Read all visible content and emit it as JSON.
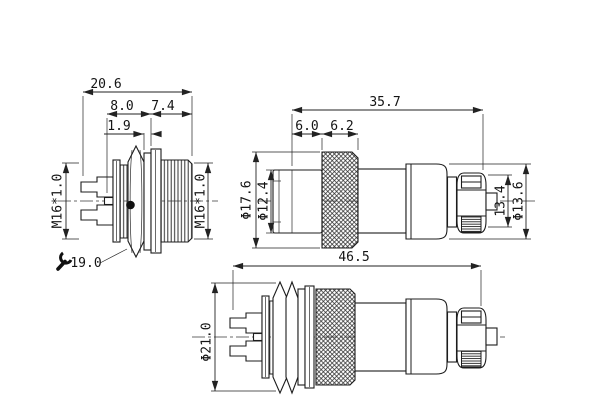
{
  "drawing": {
    "title_hint": "connector dimensional drawing",
    "colors": {
      "line": "#1c1c1c",
      "background": "#ffffff"
    },
    "socket_view": {
      "len_total": "20.6",
      "len_rear": "8.0",
      "len_front": "7.4",
      "washer_thickness": "1.9",
      "thread_rear": "M16*1.0",
      "thread_front": "M16*1.0",
      "hex_wrench_size": "19.0"
    },
    "plug_view": {
      "len_total": "35.7",
      "seg_front": "6.0",
      "seg_knurl": "6.2",
      "dia_coupling": "Φ17.6",
      "dia_mating": "Φ12.4",
      "clamp_height": "13.4",
      "dia_shell": "Φ13.6"
    },
    "assembly_view": {
      "len_total": "46.5",
      "dia_max": "Φ21.0"
    }
  }
}
